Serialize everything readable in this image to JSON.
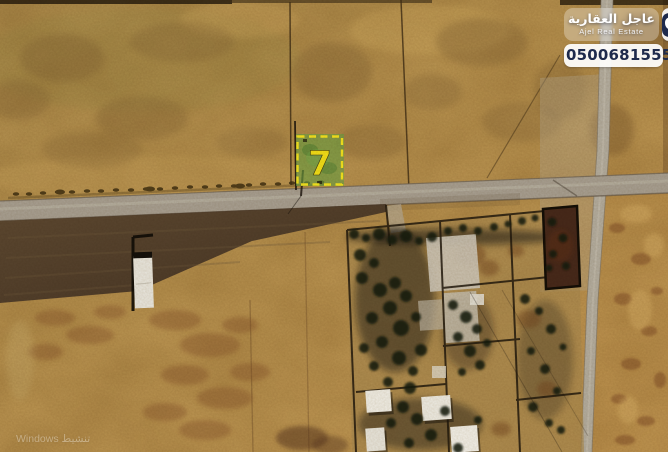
{
  "map": {
    "alt": "Satellite aerial view of desert land plots beside a road junction, with a walled farm compound and a plot highlighted for sale",
    "plot_marker": {
      "number": "7"
    }
  },
  "branding": {
    "name_ar": "عاجل العقارية",
    "name_en": "Ajel Real Estate",
    "phone": "0500681555"
  },
  "watermark": {
    "text": "تنشيط Windows"
  },
  "palette": {
    "highlight_yellow": "#f4e41e",
    "plot_green": "#6aa344",
    "brand_navy": "#1e2a4c",
    "desert_tan": "#bb9552",
    "road_gray": "#a8a093",
    "field_brown": "#4e3c29",
    "tree_green": "#151b0c"
  }
}
